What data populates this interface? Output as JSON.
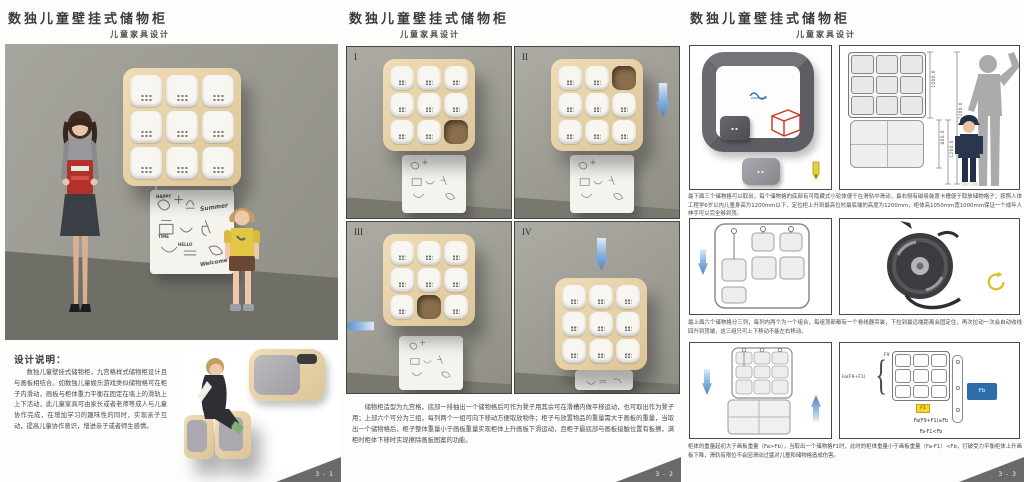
{
  "page": {
    "title": "数独儿童壁挂式储物柜",
    "subtitle": "儿童家具设计"
  },
  "left": {
    "heading": "设计说明：",
    "description": "数独儿童壁挂式储物柜，九宫格样式储物柜设计且与画板相结合。如数独儿童娱乐游戏类似储物格可在柜子内滑动，画板与柜体重力平衡在固定在墙上的滑轨上上下活动，此儿童家具可由家长或者老师等成人与儿童协作完成，在增加学习的趣味性的同时，实现亲子互动，提高儿童协作意识，增进亲子或者师生感情。",
    "board_words": [
      "HAPPY",
      "Summer",
      "Welcome",
      "HELLO",
      "TIME"
    ],
    "page_number": "3 - 1"
  },
  "middle": {
    "views": [
      {
        "label": "I"
      },
      {
        "label": "II"
      },
      {
        "label": "III"
      },
      {
        "label": "IV"
      }
    ],
    "caption": "储物柜造型为九宫格，底部一排抽出一个储物格后可作为凳子用其余可在滑槽内做平移运动，也可取出作为凳子用；上部六个可分为三组，每列两个一组可向下移动方便取放物件；柜子与放置物品的重量需大于画板的重量，当取出一个储物格后，柜子整体重量小于画板重量实现柜体上升画板下滑运动，且柜子最底部与画板接触位置有板擦，满柜时柜体下移时实现擦除画板图案的功能。",
    "page_number": "3 - 2"
  },
  "right": {
    "notes": [
      "最下面三个储物格可以取出，每个储物格的底部有可隐藏式小轮体便于在滑轨中滑动，最右侧有磁吸装置卡槽便于取放储物格子；按照人体工程学6岁以内儿童身高为1200mm以下，定位柜上升到最高位时最底端的高度为1200mm，柜体高1050mm宽1000mm保证一个成年人伸手可以完全够到顶。",
      "最上面六个储物格分三列，每列内两个为一个组合，每组顶部都有一个卷线器吊装，下拉到最远端距离会固定住，再次拉动一次会自动收线回升到顶端，这三组只可上下移动不能左右移动。",
      "柜体的重量起初大于画板重量（Fa>Fb），当取出一个储物格F1时，此时的柜体重量小于画板重量（Fa-F1）<Fb，打破受力平衡柜体上升画板下降，滑轨有限位不会因滑动过猛对儿童和储物格造成伤害。"
    ],
    "dims": [
      "1000.0",
      "800.0",
      "1200.0",
      "2200.0"
    ],
    "force": {
      "brace_label": "Fa(F9+F1)",
      "cell_label": "F9",
      "removed_label": "F1",
      "board_label": "Fb",
      "formula_full": "Fa(F9+F1)≥Fb",
      "formula_removed": "Fa-F1<Fb"
    },
    "page_number": "3 - 3"
  },
  "colors": {
    "accent_blue": "#4f86c2",
    "force_blue": "#2e6cab",
    "highlight_yellow": "#f5d62a",
    "wood": "#e7d3ab",
    "wall_gray": "#9a9991",
    "page_marker_gray": "#6a6a68",
    "red_outline": "#d03020"
  }
}
